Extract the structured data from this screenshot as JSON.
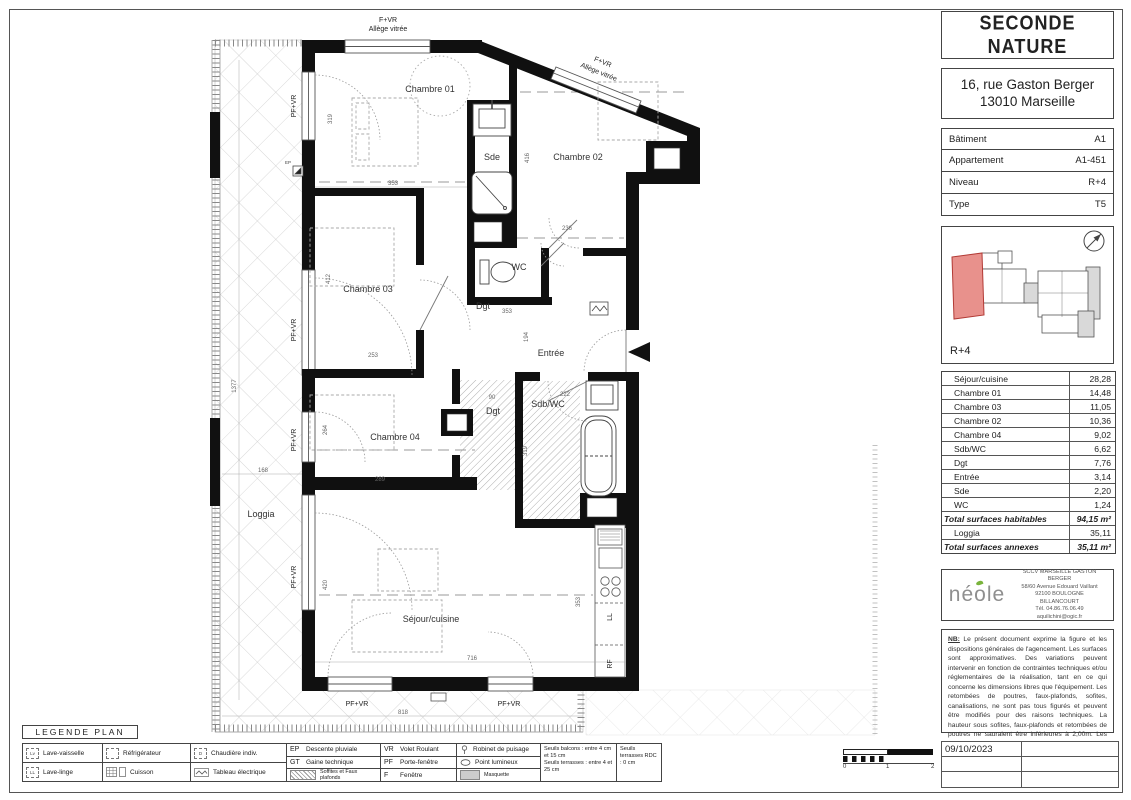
{
  "header": {
    "project": "SECONDE NATURE",
    "address_line1": "16, rue Gaston Berger",
    "address_line2": "13010 Marseille"
  },
  "info": {
    "rows": [
      {
        "label": "Bâtiment",
        "value": "A1"
      },
      {
        "label": "Appartement",
        "value": "A1-451"
      },
      {
        "label": "Niveau",
        "value": "R+4"
      },
      {
        "label": "Type",
        "value": "T5"
      }
    ]
  },
  "key_plan": {
    "level_label": "R+4",
    "highlight_color": "#e8918c"
  },
  "surface_table": {
    "rows": [
      {
        "label": "Séjour/cuisine",
        "value": "28,28"
      },
      {
        "label": "Chambre 01",
        "value": "14,48"
      },
      {
        "label": "Chambre 03",
        "value": "11,05"
      },
      {
        "label": "Chambre 02",
        "value": "10,36"
      },
      {
        "label": "Chambre 04",
        "value": "9,02"
      },
      {
        "label": "Sdb/WC",
        "value": "6,62"
      },
      {
        "label": "Dgt",
        "value": "7,76"
      },
      {
        "label": "Entrée",
        "value": "3,14"
      },
      {
        "label": "Sde",
        "value": "2,20"
      },
      {
        "label": "WC",
        "value": "1,24"
      }
    ],
    "total_habitable_label": "Total surfaces habitables",
    "total_habitable_value": "94,15 m²",
    "loggia_label": "Loggia",
    "loggia_value": "35,11",
    "total_annexes_label": "Total surfaces annexes",
    "total_annexes_value": "35,11 m²"
  },
  "developer": {
    "logo_text": "néole",
    "name_line1": "SCCV MARSEILLE GASTON",
    "name_line2": "BERGER",
    "address1": "58/60 Avenue Edouard Vaillant",
    "address2": "92100 BOULOGNE",
    "address3": "BILLANCOURT",
    "phone": "Tél. 04.86.76.06.49",
    "email": "aquilichini@ogic.fr"
  },
  "disclaimer": {
    "nb_label": "NB:",
    "text": " Le présent document exprime la figure et les dispositions générales de l'agencement. Les surfaces sont approximatives. Des variations peuvent intervenir en fonction de contraintes techniques et/ou réglementaires de la réalisation, tant en ce qui concerne les dimensions libres que l'équipement. Les retombées de poutres, faux-plafonds, sofites, canalisations, ne sont pas tous figurés et peuvent être modifiés pour des raisons techniques. La hauteur sous sofites, faux-plafonds et retombées de poutres ne sauraient être inférieures à 2,00m. Les éléments de mobilier de cuisine et les implantations des équipements électriques sont présentés à titre indicatif."
  },
  "date_block": {
    "date": "09/10/2023"
  },
  "scale_bar": {
    "labels": [
      "0",
      "1",
      "2"
    ]
  },
  "legend": {
    "title": "LEGENDE PLAN",
    "lv_abbr": "Lv",
    "lave_vaisselle": "Lave-vaisselle",
    "ll_abbr": "LL",
    "lave_linge": "Lave-linge",
    "refrigerateur": "Réfrigérateur",
    "cuisson": "Cuisson",
    "chaudiere_abbr": "D",
    "chaudiere": "Chaudière indiv.",
    "tableau": "Tableau électrique",
    "ep_abbr": "EP",
    "ep": "Descente pluviale",
    "gt_abbr": "GT",
    "gt": "Gaine technique",
    "soffites": "Soffites et Faux plafonds",
    "vr_abbr": "VR",
    "vr": "Volet Roulant",
    "pf_abbr": "PF",
    "pf": "Porte-fenêtre",
    "f_abbr": "F",
    "f": "Fenêtre",
    "robinet": "Robinet de puisage",
    "point_lumineux": "Point lumineux",
    "masquette": "Masquette",
    "seuils_balcons": "Seuils balcons : entre 4 cm et 15 cm",
    "seuils_terrasses": "Seuils terrasses : entre 4 et 25 cm",
    "seuils_rdc": "Seuils terrasses RDC : 0 cm"
  },
  "plan": {
    "rooms": {
      "chambre01": "Chambre 01",
      "chambre02": "Chambre 02",
      "chambre03": "Chambre 03",
      "chambre04": "Chambre 04",
      "sejour": "Séjour/cuisine",
      "sde": "Sde",
      "wc": "WC",
      "dgt": "Dgt",
      "dgt2": "Dgt",
      "entree": "Entrée",
      "sdb": "Sdb/WC",
      "loggia": "Loggia"
    },
    "wall_labels": {
      "f_vr": "F+VR",
      "allege": "Allège vitrée",
      "pf_vr": "PF+VR",
      "ll": "LL",
      "rf": "RF",
      "ep": "EP"
    },
    "dims": {
      "d319a": "319",
      "d353a": "353",
      "d416": "416",
      "d236": "236",
      "d412": "412",
      "d253": "253",
      "d353b": "353",
      "d194": "194",
      "d90": "90",
      "d222": "222",
      "d319b": "319",
      "d264": "264",
      "d289": "289",
      "d1377": "1377",
      "d168": "168",
      "d420": "420",
      "d716": "716",
      "d353c": "353",
      "d818": "818"
    }
  }
}
